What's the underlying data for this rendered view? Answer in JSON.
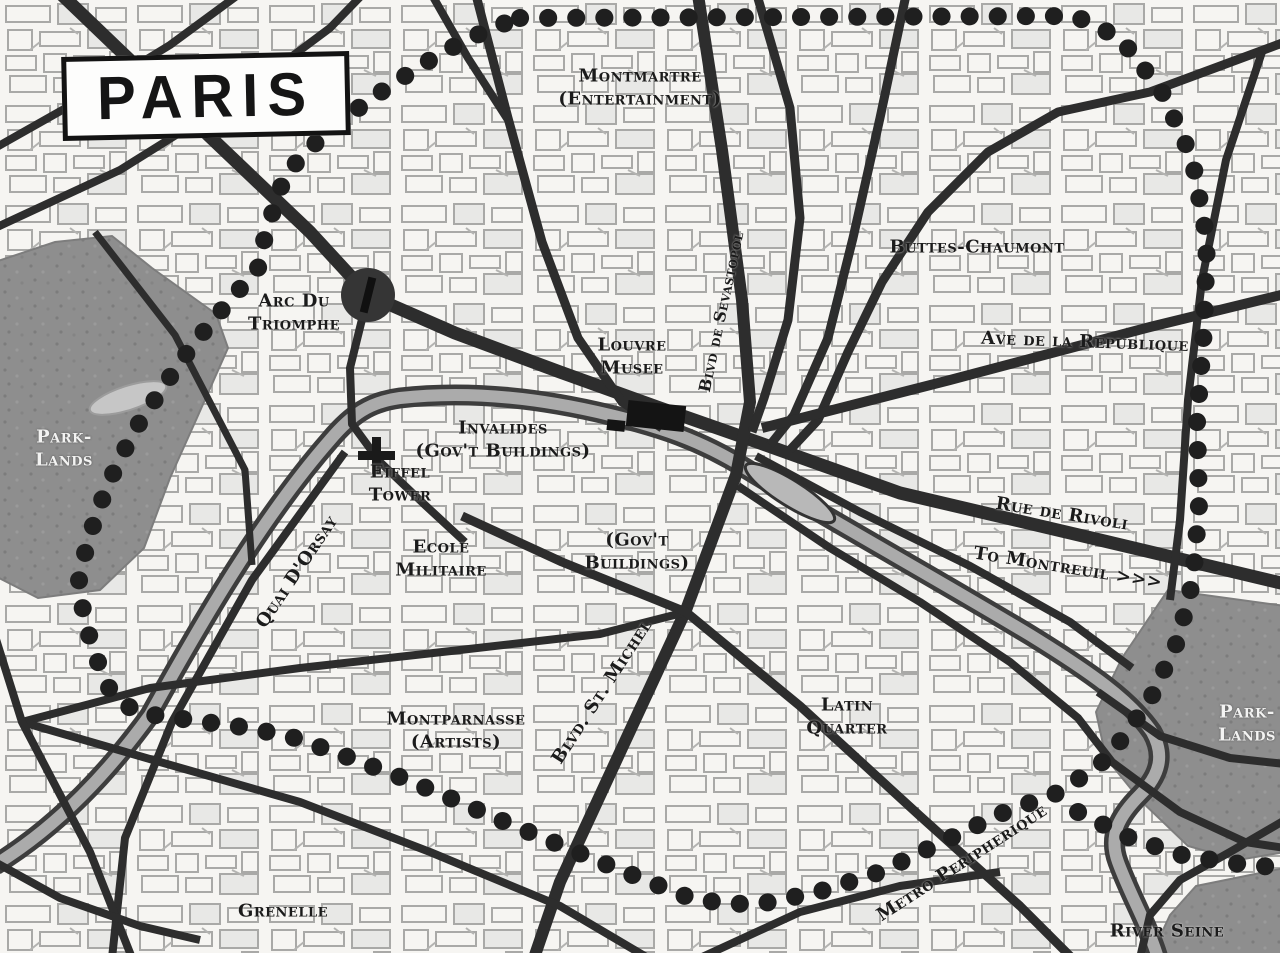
{
  "title": "PARIS",
  "colors": {
    "background": "#f6f5f2",
    "road": "#2d2d2d",
    "metro_dots": "#1f1f1f",
    "park": "#8e8e8e",
    "river": "#ababab",
    "label": "#1b1b1b",
    "park_label": "#f3f3f2"
  },
  "icons": {
    "arc_roundabout": "filled-circle-marker",
    "eiffel_tower": "cross-marker",
    "louvre_building": "black-rectangle-marker",
    "metro_line": "dotted-line",
    "seine_river": "gray-band",
    "montreuil_arrows": "chevrons-right"
  },
  "labels": {
    "montmartre": {
      "line1": "Montmartre",
      "line2": "(Entertainment)"
    },
    "buttes_chaumont": {
      "text": "Buttes-Chaumont"
    },
    "ave_republique": {
      "text": "Ave de la Republique"
    },
    "arc_triomphe": {
      "line1": "Arc Du",
      "line2": "Triomphe"
    },
    "louvre": {
      "line1": "Louvre",
      "line2": "Musee"
    },
    "sevastopol": {
      "text": "Blvd de Sevastopol"
    },
    "parklands_west": {
      "line1": "Park-",
      "line2": "Lands"
    },
    "invalides": {
      "line1": "Invalides",
      "line2": "(Gov't Buildings)"
    },
    "eiffel": {
      "line1": "Eiffel",
      "line2": "Tower"
    },
    "quai_dorsay": {
      "text": "Quai D'Orsay"
    },
    "ecole_militaire": {
      "line1": "Ecole",
      "line2": "Militaire"
    },
    "govt_buildings": {
      "line1": "(Gov't",
      "line2": "Buildings)"
    },
    "rue_rivoli": {
      "text": "Rue de Rivoli"
    },
    "to_montreuil": {
      "text": "To Montreuil >>>"
    },
    "blvd_st_michel": {
      "text": "Blvd. St. Michel"
    },
    "latin_quarter": {
      "line1": "Latin",
      "line2": "Quarter"
    },
    "montparnasse": {
      "line1": "Montparnasse",
      "line2": "(Artists)"
    },
    "parklands_east": {
      "line1": "Park-",
      "line2": "Lands"
    },
    "metro_peripherique": {
      "text": "Metro Peripherique"
    },
    "grenelle": {
      "text": "Grenelle"
    },
    "river_seine": {
      "text": "River Seine"
    }
  }
}
